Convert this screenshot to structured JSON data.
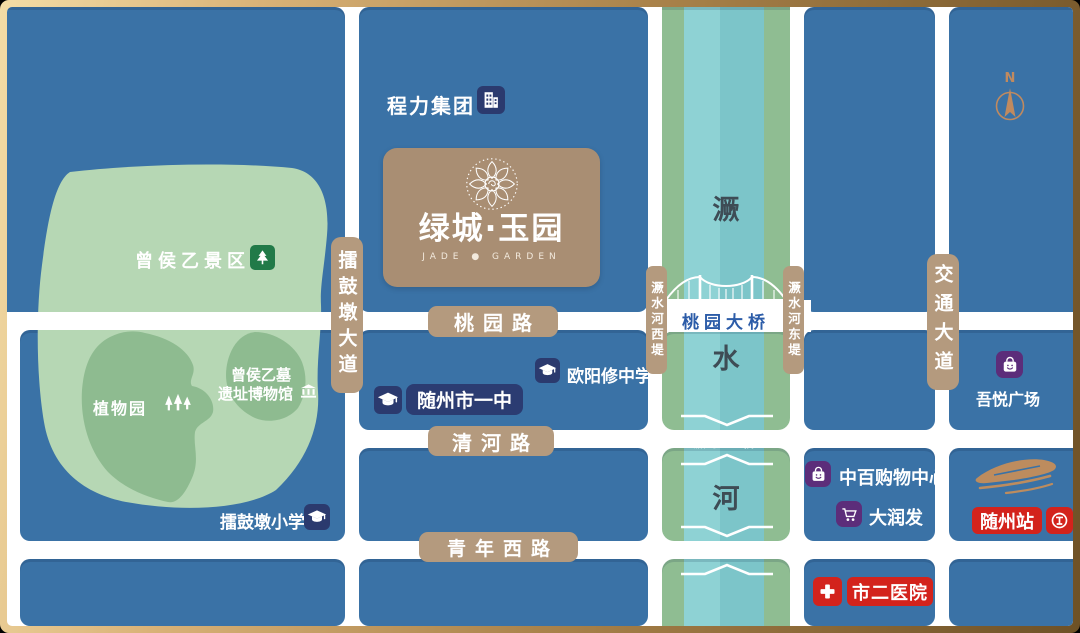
{
  "company": {
    "label": "程力集团"
  },
  "logo": {
    "title": "绿城·玉园",
    "subtitle": "JADE ● GARDEN"
  },
  "park": {
    "area": "曾侯乙景区",
    "botanic": "植物园",
    "tomb_line1": "曾侯乙墓",
    "tomb_line2": "遗址博物馆"
  },
  "schools": {
    "no1": "随州市一中",
    "ouyang": "欧阳修中学",
    "primary": "擂鼓墩小学"
  },
  "roads": {
    "taoyuan": "桃园路",
    "qinghe": "清河路",
    "qingnianxi": "青年西路",
    "leigudun": "擂鼓墩大道",
    "jiaotong": "交通大道"
  },
  "river": {
    "char1": "㵐",
    "char2": "水",
    "char3": "河",
    "west_dike": "㵐水河西堤",
    "east_dike": "㵐水河东堤"
  },
  "bridges": {
    "taoyuan": "桃园大桥",
    "jueshui2": "㵐水二桥",
    "qingnian": "青年路大桥"
  },
  "shops": {
    "wuyue": "吾悦广场",
    "zhongbai": "中百购物中心",
    "darunfa": "大润发"
  },
  "station": {
    "label": "随州站"
  },
  "hospital": {
    "label": "市二医院"
  },
  "compass": {
    "n": "N"
  },
  "colors": {
    "map_blue": "#3a72a6",
    "road_white": "#ffffff",
    "park_light": "#b6d7b4",
    "park_dark": "#8ebb90",
    "river_teal": "#84c9cd",
    "river_bank_green": "#8fbd92",
    "road_label_tan": "#b49a7e",
    "icon_navy": "#2b3a6e",
    "icon_purple": "#5c2d7a",
    "alert_red": "#d3231c",
    "bridge_text_blue": "#2c5ca8",
    "bronze": "#bd8c5e",
    "frame_gold": "#d9b277",
    "logo_card_tan": "#a98e73"
  }
}
